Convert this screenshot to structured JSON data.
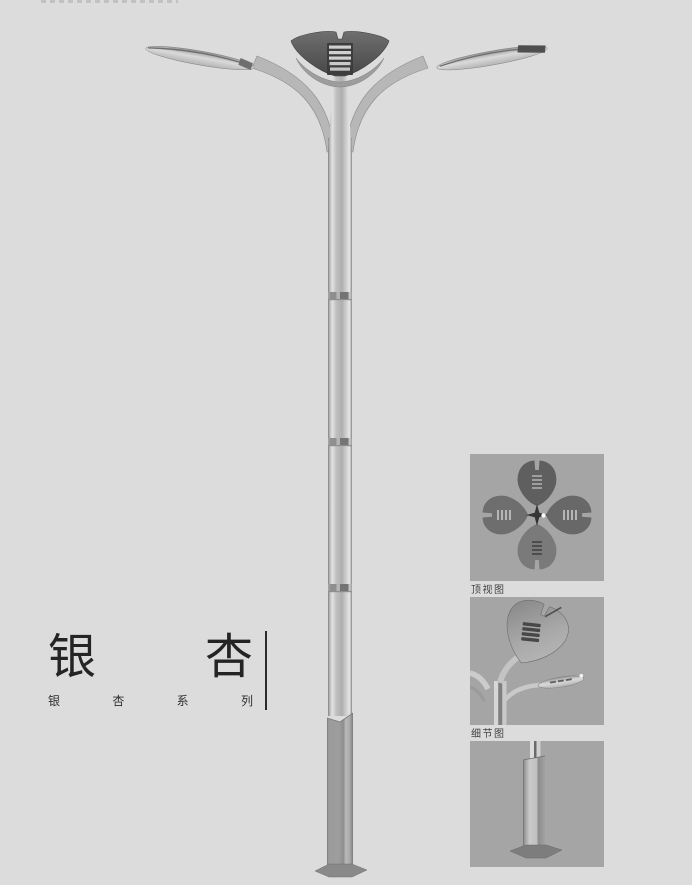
{
  "page": {
    "background": "#dcdcdc"
  },
  "title_block": {
    "title_chars": [
      "银",
      "杏"
    ],
    "subtitle_chars": [
      "银",
      "杏",
      "系",
      "列"
    ]
  },
  "panels": {
    "background": "#a5a5a5",
    "items": [
      {
        "id": "top-view",
        "caption": "顶视图"
      },
      {
        "id": "detail-view",
        "caption": "细节图"
      },
      {
        "id": "base-view",
        "caption": ""
      }
    ]
  },
  "lamp": {
    "colors": {
      "crown_dark": "#4f4f4f",
      "louver_light": "#cfcfcf",
      "metal_light": "#c6c6c6",
      "metal_edge": "#8a8a8a",
      "base_column": "#9a9a9a",
      "base_plate": "#898989"
    }
  }
}
